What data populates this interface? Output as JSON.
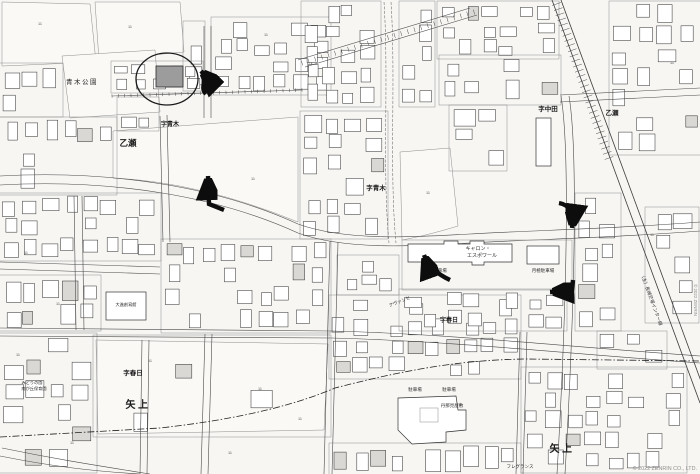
{
  "page": {
    "width": 700,
    "height": 474,
    "type": "zenrin-residential-map-screenshot"
  },
  "map": {
    "background": "#f7f6f3",
    "parcel_stroke": "#8d8d8d",
    "building_stroke": "#3c3c3c",
    "road_stroke": "#4a4a4a",
    "annotation_color": "#0d0d0d",
    "highlight_building_fill": "#9c9c9c",
    "copyright": "© 2022 ZENRIN CO., LTD.",
    "edge_copyright": "© 2022 ZENRIN",
    "road_name": "（主）長崎芒塚インター線",
    "lot_number_text": "11",
    "area_labels": [
      {
        "text": "青木公園",
        "x": 82,
        "y": 84,
        "size": 6.5,
        "bold": false,
        "spacing": 1.5
      },
      {
        "text": "字青木",
        "x": 170,
        "y": 126,
        "size": 6,
        "bold": true
      },
      {
        "text": "乙瀬",
        "x": 128,
        "y": 146,
        "size": 8.5,
        "bold": true
      },
      {
        "text": "字青木",
        "x": 376,
        "y": 190,
        "size": 6.5,
        "bold": true
      },
      {
        "text": "字中田",
        "x": 548,
        "y": 111,
        "size": 6.5,
        "bold": true
      },
      {
        "text": "乙瀬",
        "x": 612,
        "y": 115,
        "size": 6.5,
        "bold": true
      },
      {
        "text": "字春日",
        "x": 133,
        "y": 375,
        "size": 6.5,
        "bold": true
      },
      {
        "text": "矢上",
        "x": 138,
        "y": 408,
        "size": 10,
        "bold": true,
        "spacing": 2.5
      },
      {
        "text": "字春日",
        "x": 449,
        "y": 322,
        "size": 6,
        "bold": true
      },
      {
        "text": "矢上",
        "x": 562,
        "y": 452,
        "size": 10,
        "bold": true,
        "spacing": 2.5
      }
    ],
    "small_labels": [
      {
        "text": "キャロン・",
        "x": 478,
        "y": 250,
        "size": 5
      },
      {
        "text": "エスポワール",
        "x": 482,
        "y": 257,
        "size": 5
      },
      {
        "text": "駐車場",
        "x": 440,
        "y": 272,
        "size": 4.5
      },
      {
        "text": "月極駐車場",
        "x": 543,
        "y": 272,
        "size": 4.5
      },
      {
        "text": "駐車場",
        "x": 415,
        "y": 391,
        "size": 4.5
      },
      {
        "text": "駐車場",
        "x": 449,
        "y": 391,
        "size": 4.5
      },
      {
        "text": "丹那見屋敷",
        "x": 452,
        "y": 407,
        "size": 4.5
      },
      {
        "text": "アヴァンセ",
        "x": 400,
        "y": 303,
        "size": 4.5,
        "rotate": -22
      },
      {
        "text": "フレグランス",
        "x": 520,
        "y": 468,
        "size": 4.5
      },
      {
        "text": "大進創寫館",
        "x": 126,
        "y": 306,
        "size": 4.2
      },
      {
        "text": "みどりの園",
        "x": 32,
        "y": 384,
        "size": 4.2
      },
      {
        "text": "南が丘保育園",
        "x": 34,
        "y": 390,
        "size": 4.2
      }
    ],
    "lot_numbers": [
      {
        "x": 40,
        "y": 25
      },
      {
        "x": 130,
        "y": 28
      },
      {
        "x": 266,
        "y": 36
      },
      {
        "x": 253,
        "y": 180
      },
      {
        "x": 428,
        "y": 194
      },
      {
        "x": 672,
        "y": 64
      },
      {
        "x": 652,
        "y": 236
      },
      {
        "x": 26,
        "y": 254
      },
      {
        "x": 58,
        "y": 305
      },
      {
        "x": 18,
        "y": 356
      },
      {
        "x": 150,
        "y": 362
      },
      {
        "x": 260,
        "y": 390
      },
      {
        "x": 300,
        "y": 420
      },
      {
        "x": 230,
        "y": 454
      },
      {
        "x": 72,
        "y": 444
      }
    ],
    "arrows": [
      {
        "id": "route-arrow-1",
        "description": "curved arrow pointing to circled destination building"
      },
      {
        "id": "route-arrow-2",
        "description": "arrow pointing up from main road into field"
      },
      {
        "id": "route-arrow-3",
        "description": "curved arrow pointing up-left at parking entrance"
      },
      {
        "id": "route-arrow-4",
        "description": "arrow pointing left at east street corner"
      },
      {
        "id": "route-arrow-5",
        "description": "curved arrow pointing down along east street"
      }
    ]
  }
}
